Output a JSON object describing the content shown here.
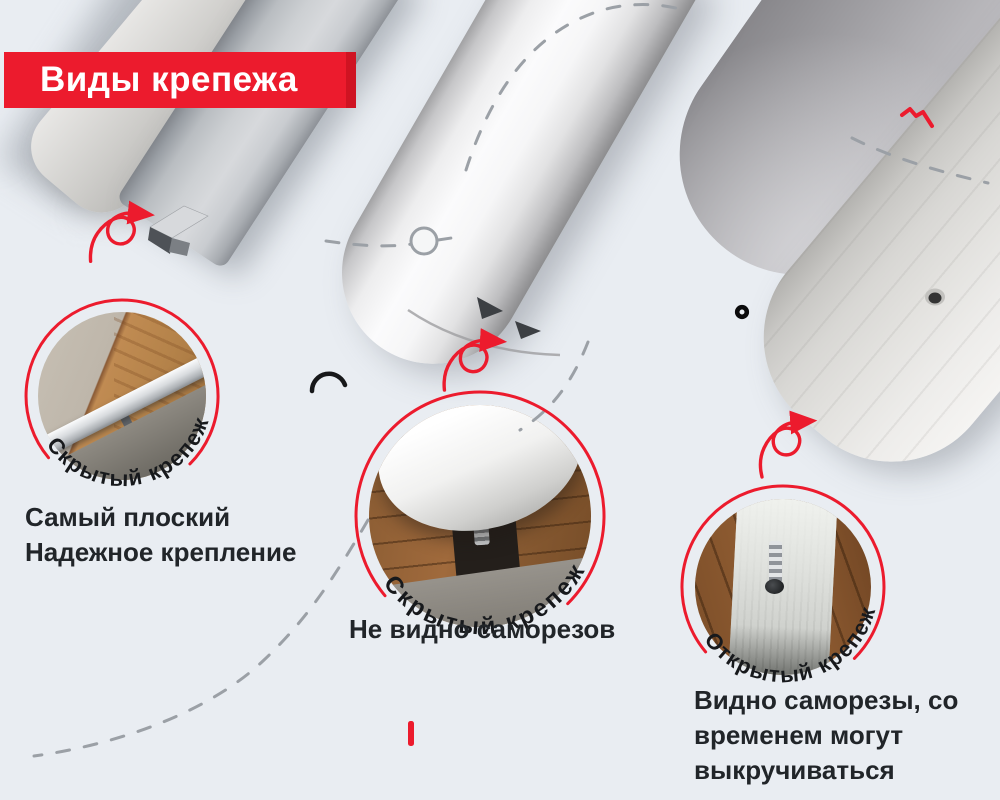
{
  "page": {
    "background": "#e9edf2"
  },
  "banner": {
    "label": "Виды крепежа"
  },
  "colors": {
    "accent_red": "#ec1b2d",
    "dash_gray": "#9ba0a6",
    "text_dark": "#212529",
    "banner_bg": "#ec1b2d"
  },
  "callouts": [
    {
      "badge": "Скрытый крепеж",
      "desc_lines": [
        "Самый плоский",
        "Надежное крепление"
      ]
    },
    {
      "badge": "Скрытый крепеж",
      "desc_lines": [
        "Не видно саморезов"
      ]
    },
    {
      "badge": "Открытый крепеж",
      "desc_lines": [
        "Видно саморезы, со",
        "временем могут",
        "выкручиваться"
      ]
    }
  ]
}
